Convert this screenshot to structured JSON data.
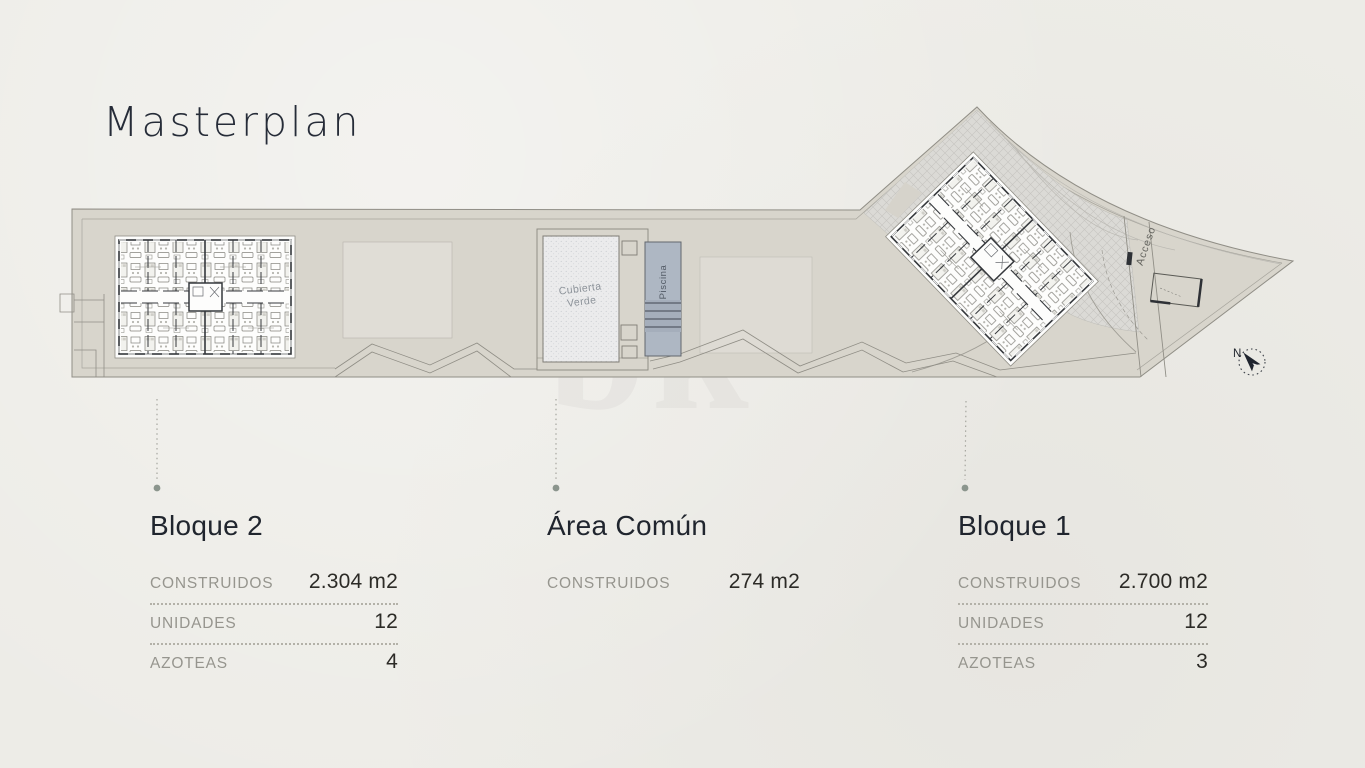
{
  "title": "Masterplan",
  "watermark": "bk",
  "plan": {
    "cubierta_line1": "Cubierta",
    "cubierta_line2": "Verde",
    "piscina": "Piscina",
    "acceso": "Acceso",
    "north": "N"
  },
  "legend": {
    "columns": [
      {
        "heading": "Bloque 2",
        "rows": [
          {
            "label": "CONSTRUIDOS",
            "value": "2.304 m2"
          },
          {
            "label": "UNIDADES",
            "value": "12"
          },
          {
            "label": "AZOTEAS",
            "value": "4"
          }
        ]
      },
      {
        "heading": "Área Común",
        "rows": [
          {
            "label": "CONSTRUIDOS",
            "value": "274 m2"
          }
        ]
      },
      {
        "heading": "Bloque 1",
        "rows": [
          {
            "label": "CONSTRUIDOS",
            "value": "2.700 m2"
          },
          {
            "label": "UNIDADES",
            "value": "12"
          },
          {
            "label": "AZOTEAS",
            "value": "3"
          }
        ]
      }
    ]
  },
  "colors": {
    "background": "#edece7",
    "site_fill": "#d8d5cc",
    "pool_fill": "#aeb7c3",
    "heading_dark": "#20252e",
    "label_gray": "#96958e",
    "leader_dot": "#8b958d"
  }
}
